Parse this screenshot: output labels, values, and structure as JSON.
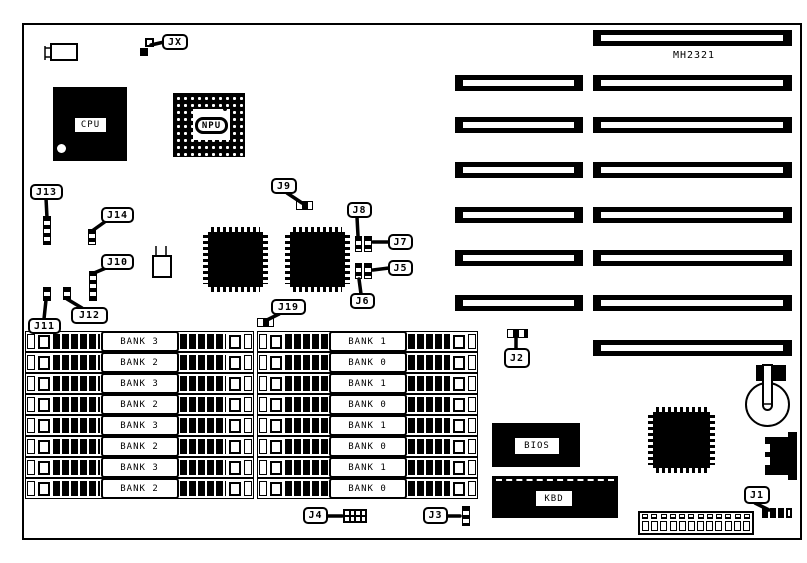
{
  "board": {
    "model": "MH2321"
  },
  "chips": {
    "cpu_label": "CPU",
    "npu_label": "NPU",
    "bios_label": "BIOS",
    "kbd_label": "KBD"
  },
  "jumper_labels": {
    "jx": "JX",
    "j13": "J13",
    "j14": "J14",
    "j10": "J10",
    "j11": "J11",
    "j12": "J12",
    "j9": "J9",
    "j8": "J8",
    "j7": "J7",
    "j5": "J5",
    "j6": "J6",
    "j19": "J19",
    "j2": "J2",
    "j4": "J4",
    "j3": "J3",
    "j1": "J1"
  },
  "memory_banks": {
    "left_column": [
      "BANK 3",
      "BANK 2",
      "BANK 3",
      "BANK 2",
      "BANK 3",
      "BANK 2",
      "BANK 3",
      "BANK 2"
    ],
    "right_column": [
      "BANK 1",
      "BANK 0",
      "BANK 1",
      "BANK 0",
      "BANK 1",
      "BANK 0",
      "BANK 1",
      "BANK 0"
    ]
  },
  "expansion_slots": {
    "left_column_count": 6,
    "right_column_count": 8
  }
}
